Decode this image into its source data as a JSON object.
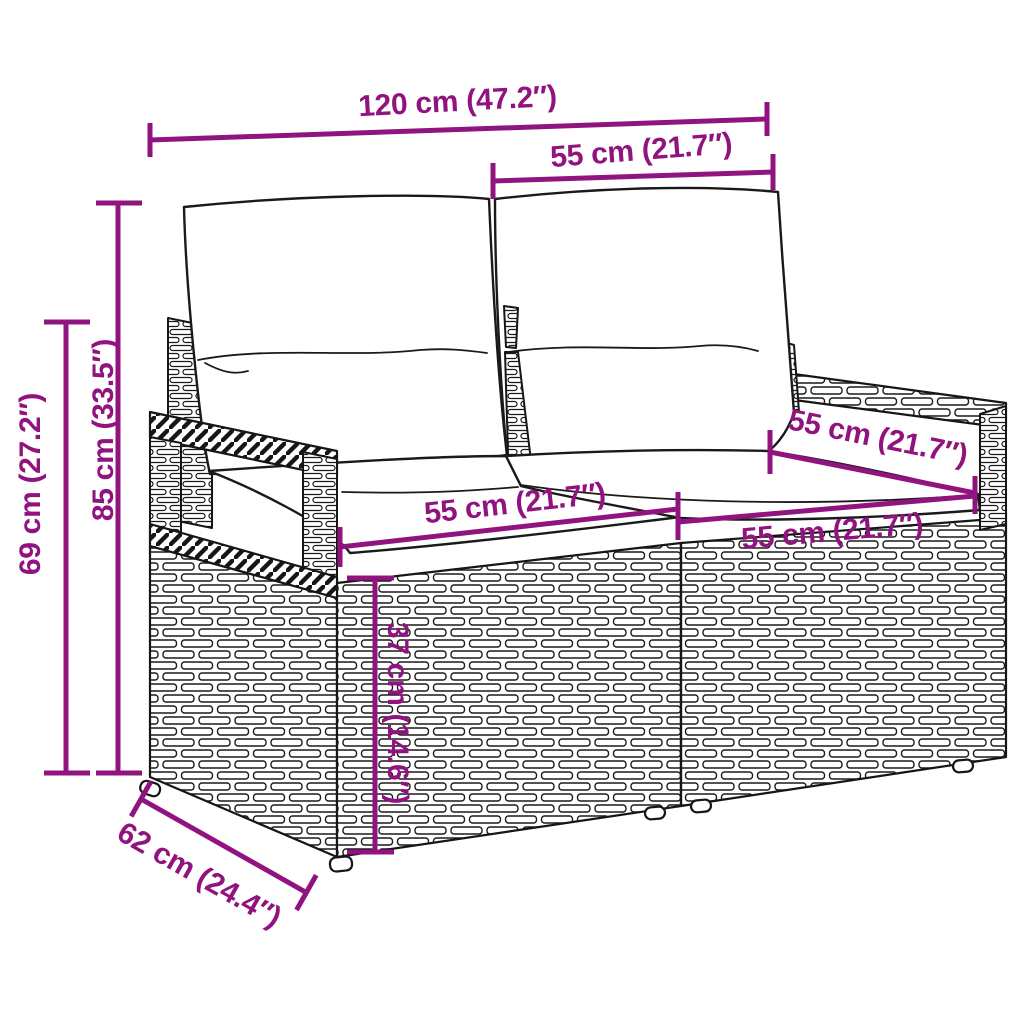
{
  "accent_color": "#91137F",
  "dims": {
    "total_width": "120 cm (47.2″)",
    "back_section_width": "55 cm (21.7″)",
    "total_height": "85 cm (33.5″)",
    "frame_height": "69 cm (27.2″)",
    "left_seat_width": "55 cm (21.7″)",
    "right_seat_depth": "55 cm (21.7″)",
    "right_seat_width": "55 cm (21.7″)",
    "seat_height": "37 cm (14.6″)",
    "depth": "62 cm (24.4″)"
  }
}
